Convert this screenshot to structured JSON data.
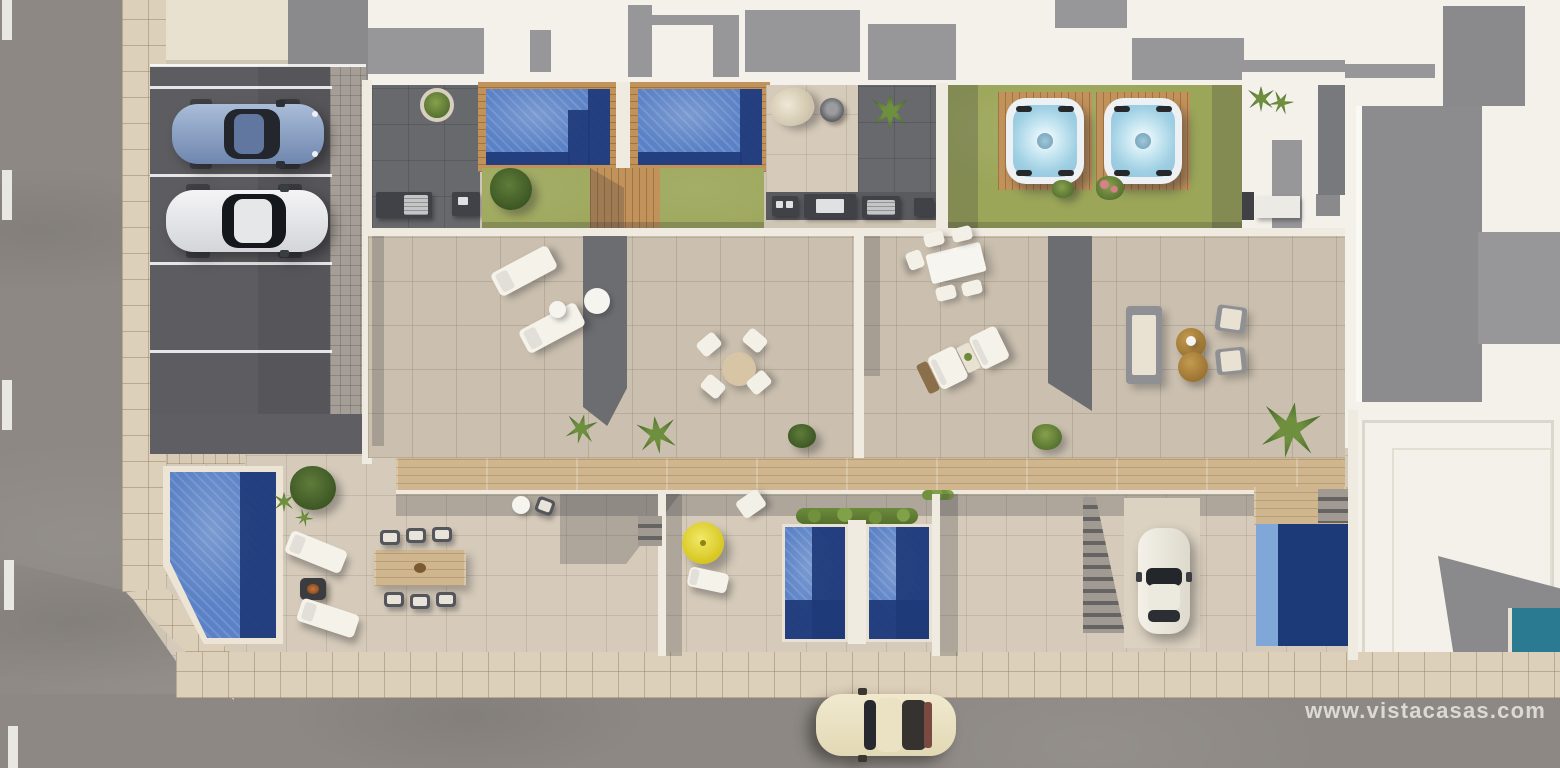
{
  "description": "Top-down aerial 3D architectural render of a residential development: four rooftop terraces with pools, lawns and hot tubs, ground-floor gardens with plunge pools, a parking lot with two cars, streets with a classic car, and neighbouring white buildings.",
  "watermark": {
    "text": "www.vistacasas.com",
    "color": "#eeebe5"
  },
  "palette": {
    "road": "#8d8883",
    "sidewalk": "#ddd0ba",
    "parking_asphalt": "#5d5d61",
    "terrace_tile": "#cbc0af",
    "dark_patio": "#67696d",
    "lawn_green": "#9ca659",
    "pool_water_light": "#5b82c6",
    "pool_water_dark": "#1e3a78",
    "wood_deck": "#c2925b",
    "hot_tub_water": "#a8d4e6",
    "wall_white": "#f0ebe0",
    "umbrella_yellow": "#e5d93e",
    "pouf_brown": "#a8803f",
    "classic_car_cream": "#ece4c9",
    "small_pool_teal": "#2a7b92"
  },
  "scene": {
    "vehicles": [
      {
        "name": "blue-coupe",
        "location": "parking-lot"
      },
      {
        "name": "silver-sedan",
        "location": "parking-lot"
      },
      {
        "name": "white-car",
        "location": "driveway"
      },
      {
        "name": "cream-classic-car",
        "location": "street"
      }
    ],
    "amenities": [
      "rooftop-pools",
      "hot-tubs",
      "sun-loungers",
      "round-dining-set",
      "rectangular-dining-set",
      "wood-dining-table",
      "lounge-sofa-set",
      "fire-pit",
      "yellow-parasol",
      "bbq-kitchens",
      "lawns",
      "wood-decks",
      "staircases",
      "hanging-chair",
      "plunge-pools"
    ]
  }
}
